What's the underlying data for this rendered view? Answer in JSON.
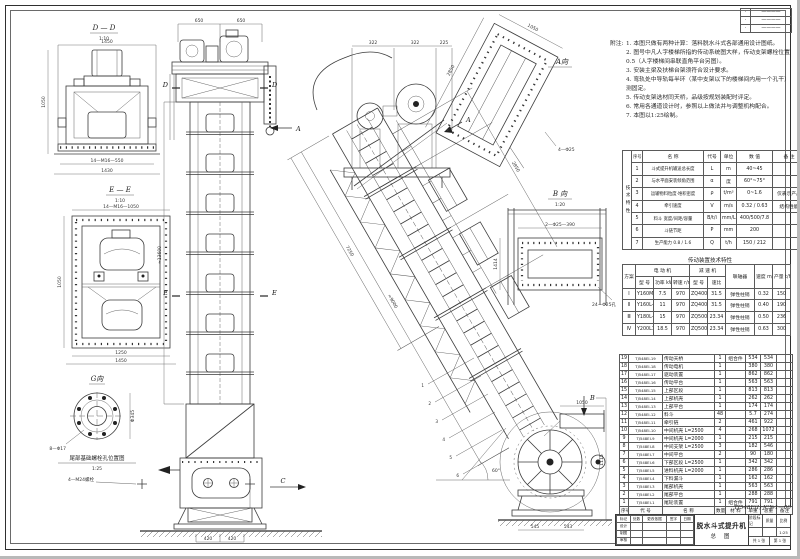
{
  "sheet": {
    "hand_no": "TJ548E(Ⅰ)·JC№1—00"
  },
  "labels": {
    "dd": "D — D",
    "dd_s": "1:10",
    "ee": "E — E",
    "ee_s": "1:10",
    "g": "G向",
    "g_cap": "尾部基础螺栓孔位置图",
    "g_cap_s": "1:25",
    "av": "A向",
    "bv": "B 向",
    "bv_s": "1:20",
    "a": "A",
    "b": "B",
    "c": "C",
    "d": "D",
    "e": "E"
  },
  "dims": {
    "dd_w": "1450",
    "dd_h": "1050",
    "dd_b1": "14—M16—550",
    "dd_b2": "1430",
    "ee_top": "14—M16—1050",
    "ee_left": "1050",
    "ee_b1": "1250",
    "ee_b2": "1450",
    "g_bolt": "8—Φ17",
    "g_dia": "Φ345",
    "anchor": "4—M24螺栓",
    "col_t1": "650",
    "col_t2": "650",
    "col_h": "≈13600",
    "col_b1": "420",
    "col_b2": "420",
    "head_t1": "322",
    "head_t2": "322",
    "head_t3": "225",
    "incl_l1": "≈9000",
    "incl_l2": "7250",
    "incl_l3": "2850",
    "angle": "60°",
    "tail_h": "1115",
    "tail_b1": "545",
    "tail_b2": "543",
    "spout_t": "1050",
    "av_l": "2850",
    "av_w": "1050",
    "av_bolt": "4—Φ25",
    "bv_top": "2—Φ25—390",
    "bv_left": "1414",
    "bv_note": "24—Φ25孔"
  },
  "callouts": [
    "1",
    "2",
    "3",
    "4",
    "5",
    "6"
  ],
  "revision_block": {
    "rows": [
      [
        "·",
        "————"
      ],
      [
        "·",
        "————"
      ],
      [
        "·",
        "————"
      ]
    ]
  },
  "notes": {
    "label": "附注:",
    "items": [
      "1. 本图只做有两种计算：落料脱水斗式各部通用设计图纸。",
      "2. 图号中凡人字楼梯所指的传动系统图大样，传动支架螺栓位置0.5（人字楼梯间串联直角平台另图）。",
      "3. 安装主梁及扶梯台架须符合设计要求。",
      "4. 弯轨处中导轨每半环（某中支架以下的楼梯间内用一个孔干）测固定。",
      "5. 传动支架选材同天桥，品级按规划装配时评定。",
      "6. 常用各通道设计时，参照以上做法并与调整机构配合。",
      "7. 本图以1:25绘制。"
    ]
  },
  "param_table": {
    "side_label": "技术特性",
    "header": [
      "序号",
      "名  称",
      "代号",
      "单位",
      "数  值",
      "备  注"
    ],
    "rows": [
      [
        "1",
        "斗式提升机输送总长度",
        "L",
        "m",
        "40~45",
        ""
      ],
      [
        "2",
        "与水平面安装倾角范围",
        "α",
        "度",
        "60°~75°",
        ""
      ],
      [
        "3",
        "运输物料粒度·堆积密度",
        "ρ",
        "t/m³",
        "0~1.6",
        "仅表示产品"
      ],
      [
        "4",
        "牵引速度",
        "V",
        "m/s",
        "0.32 / 0.63",
        "结构性能"
      ],
      [
        "5",
        "料斗 宽度/间距/容量",
        "B/t/i",
        "mm/L",
        "400/500/7.8",
        ""
      ],
      [
        "6",
        "斗链节距",
        "P",
        "mm",
        "200",
        ""
      ],
      [
        "7",
        "生产能力 0.8 / 1.6",
        "Q",
        "t/h",
        "150 / 212",
        ""
      ]
    ]
  },
  "drive_table": {
    "title": "传动装置技术特性",
    "group_plan": "方案",
    "group_motor": "电 动 机",
    "group_reducer": "减 速 机",
    "group_coupling": "联轴器",
    "group_speed": "速度 m/s",
    "group_capacity": "产量 t/h",
    "sub_model": "型  号",
    "sub_power": "功率 kW",
    "sub_speed": "转速 r/min",
    "sub_model2": "型  号",
    "sub_ratio": "速比",
    "rows": [
      [
        "Ⅰ",
        "Y160M-6",
        "7.5",
        "970",
        "ZQ400-Ⅲ-2F",
        "31.5",
        "弹性柱销",
        "0.32",
        "150"
      ],
      [
        "Ⅱ",
        "Y160L-6",
        "11",
        "970",
        "ZQ400-Ⅲ-2F",
        "31.5",
        "弹性柱销",
        "0.40",
        "190"
      ],
      [
        "Ⅲ",
        "Y180L-6",
        "15",
        "970",
        "ZQ500-Ⅲ-2F",
        "23.34",
        "弹性柱销",
        "0.50",
        "236"
      ],
      [
        "Ⅳ",
        "Y200L1-6",
        "18.5",
        "970",
        "ZQ500-Ⅲ-2F",
        "23.34",
        "弹性柱销",
        "0.63",
        "300"
      ]
    ]
  },
  "bom_table": {
    "header": [
      "序号",
      "代  号",
      "名    称",
      "数量",
      "材 料",
      "单重",
      "总重",
      "备注"
    ],
    "rows": [
      [
        "19",
        "TJ548EⅠ-19",
        "传动天桥",
        "1",
        "组合件",
        "534",
        "534",
        ""
      ],
      [
        "18",
        "TJ548EⅠ-18",
        "传动电机",
        "1",
        "",
        "380",
        "380",
        ""
      ],
      [
        "17",
        "TJ548EⅠ-17",
        "驱动装置",
        "1",
        "",
        "862",
        "862",
        ""
      ],
      [
        "16",
        "TJ548EⅠ-16",
        "传动平台",
        "1",
        "",
        "563",
        "563",
        ""
      ],
      [
        "15",
        "TJ548EⅠ-15",
        "上部区段",
        "1",
        "",
        "813",
        "813",
        ""
      ],
      [
        "14",
        "TJ548EⅠ-14",
        "上部机壳",
        "1",
        "",
        "262",
        "262",
        ""
      ],
      [
        "13",
        "TJ548EⅠ-13",
        "上部平台",
        "1",
        "",
        "174",
        "174",
        ""
      ],
      [
        "12",
        "TJ548EⅠ-12",
        "料斗",
        "48",
        "",
        "5.7",
        "274",
        ""
      ],
      [
        "11",
        "TJ548EⅠ-11",
        "牵引链",
        "2",
        "",
        "461",
        "922",
        ""
      ],
      [
        "10",
        "TJ548EⅠ-10",
        "中间机壳 L=2500",
        "4",
        "",
        "268",
        "1072",
        ""
      ],
      [
        "9",
        "TJ548EⅠ-9",
        "中间机壳 L=2000",
        "1",
        "",
        "215",
        "215",
        ""
      ],
      [
        "8",
        "TJ548EⅠ-8",
        "中间支架 L=2500",
        "3",
        "",
        "182",
        "546",
        ""
      ],
      [
        "7",
        "TJ548EⅠ-7",
        "中间平台",
        "2",
        "",
        "90",
        "180",
        ""
      ],
      [
        "6",
        "TJ548EⅠ-6",
        "下部区段 L=2500",
        "1",
        "",
        "342",
        "342",
        ""
      ],
      [
        "5",
        "TJ548EⅠ-5",
        "进料机壳 L=2000",
        "1",
        "",
        "286",
        "286",
        ""
      ],
      [
        "4",
        "TJ548EⅠ-4",
        "下料漏斗",
        "1",
        "",
        "162",
        "162",
        ""
      ],
      [
        "3",
        "TJ548EⅠ-3",
        "尾部机壳",
        "1",
        "",
        "563",
        "563",
        ""
      ],
      [
        "2",
        "TJ548EⅠ-2",
        "尾部平台",
        "1",
        "",
        "288",
        "288",
        ""
      ],
      [
        "1",
        "TJ548EⅠ-1",
        "尾轮装置",
        "1",
        "组合件",
        "791",
        "791",
        ""
      ]
    ]
  },
  "title_block": {
    "title": "脱水斗式提升机",
    "subtitle": "总 图",
    "left_rows": [
      [
        "标记",
        "处数",
        "更改依据",
        "签字",
        "日期"
      ],
      [
        "设计",
        "",
        "",
        "",
        ""
      ],
      [
        "制图",
        "",
        "",
        "",
        ""
      ],
      [
        "审核",
        "",
        "",
        "",
        ""
      ]
    ],
    "stage_label": "阶段标记",
    "mass_label": "质量",
    "scale_label": "比例",
    "scale": "1:25",
    "sheet_count": "共 1 张",
    "sheet_no": "第 1 张"
  }
}
